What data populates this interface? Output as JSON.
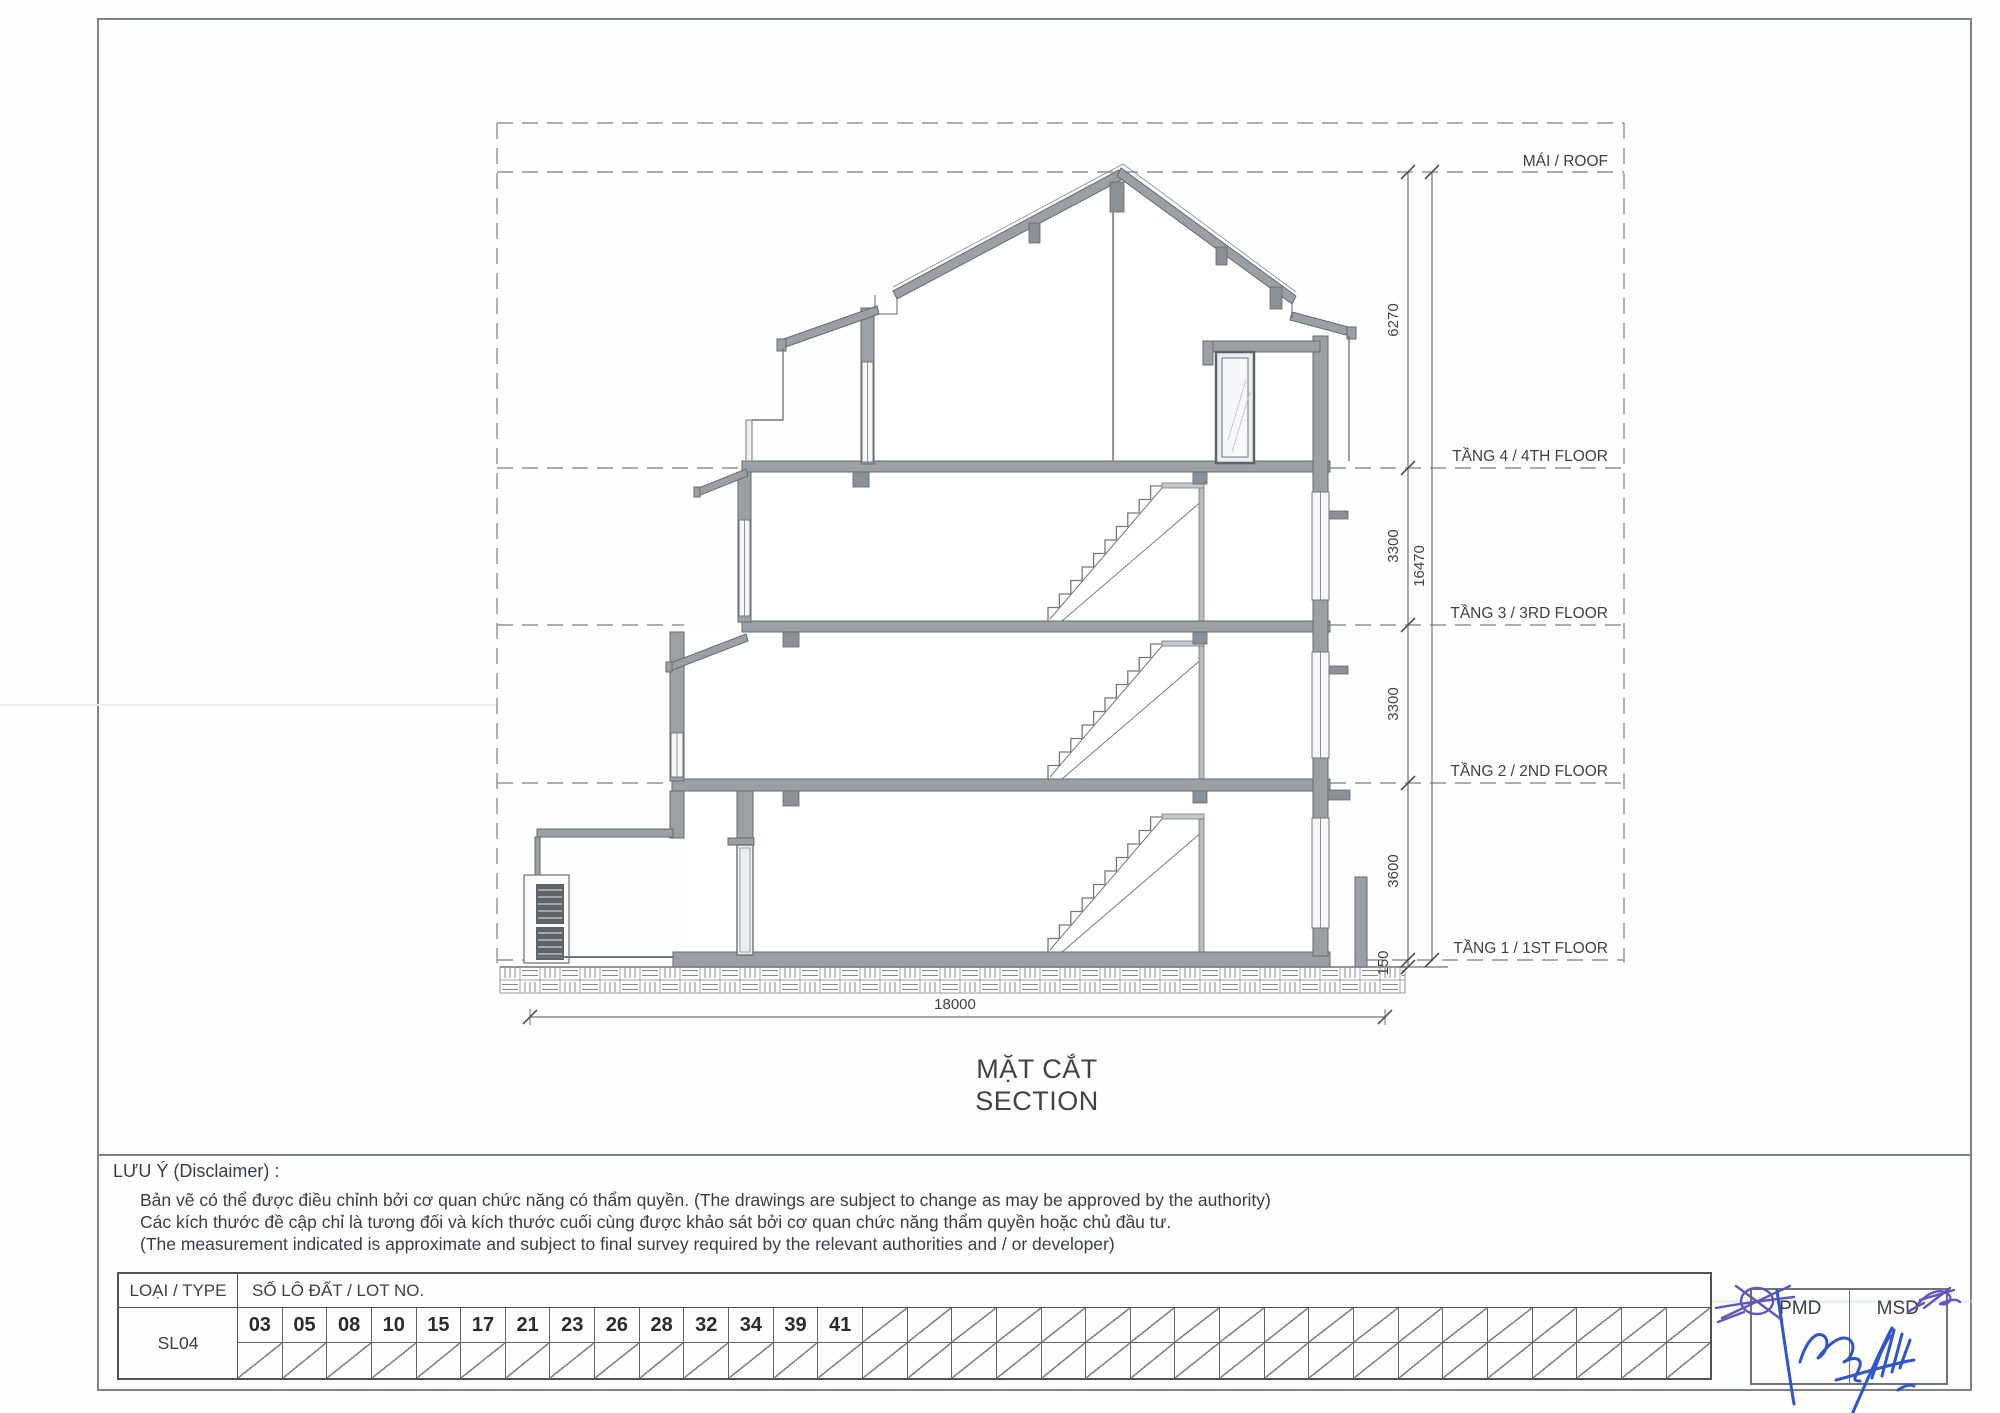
{
  "sheet": {
    "section": {
      "levels": [
        {
          "id": "roof",
          "label": "MÁI / ROOF"
        },
        {
          "id": "floor4",
          "label": "TẦNG 4 / 4TH FLOOR"
        },
        {
          "id": "floor3",
          "label": "TẦNG 3 / 3RD FLOOR"
        },
        {
          "id": "floor2",
          "label": "TẦNG 2 / 2ND FLOOR"
        },
        {
          "id": "floor1",
          "label": "TẦNG 1 / 1ST FLOOR"
        }
      ],
      "dims": {
        "roof_height": "6270",
        "floor4_height": "3300",
        "floor3_height": "3300",
        "floor2_height": "3600",
        "plinth": "150",
        "total_height": "16470",
        "overall_width": "18000"
      },
      "title_vi": "MẶT CẮT",
      "title_en": "SECTION"
    },
    "disclaimer": {
      "heading": "LƯU Ý (Disclaimer) :",
      "lines": [
        "Bản vẽ có thể được điều chỉnh bởi cơ quan chức năng có thẩm quyền. (The drawings are subject to change as may be approved by the authority)",
        "Các kích thước đề cập chỉ là tương đối và kích thước cuối cùng được khảo sát bởi cơ quan chức năng thẩm quyền hoặc chủ đầu tư.",
        "(The measurement indicated is approximate and subject to final survey required by the relevant authorities and / or developer)"
      ]
    },
    "table": {
      "type_header": "LOẠI / TYPE",
      "lot_header": "SỐ LÔ ĐẤT / LOT NO.",
      "type_value": "SL04",
      "lots": [
        "03",
        "05",
        "08",
        "10",
        "15",
        "17",
        "21",
        "23",
        "26",
        "28",
        "32",
        "34",
        "39",
        "41"
      ],
      "empty_cells": 19
    },
    "approval": {
      "left": "PMD",
      "right": "MSD"
    },
    "colors": {
      "ink_blue": "#2f55c7",
      "ink_purple": "#5e55c0",
      "wall_gray": "#9aa0a4",
      "line_gray": "#6b7074"
    }
  }
}
